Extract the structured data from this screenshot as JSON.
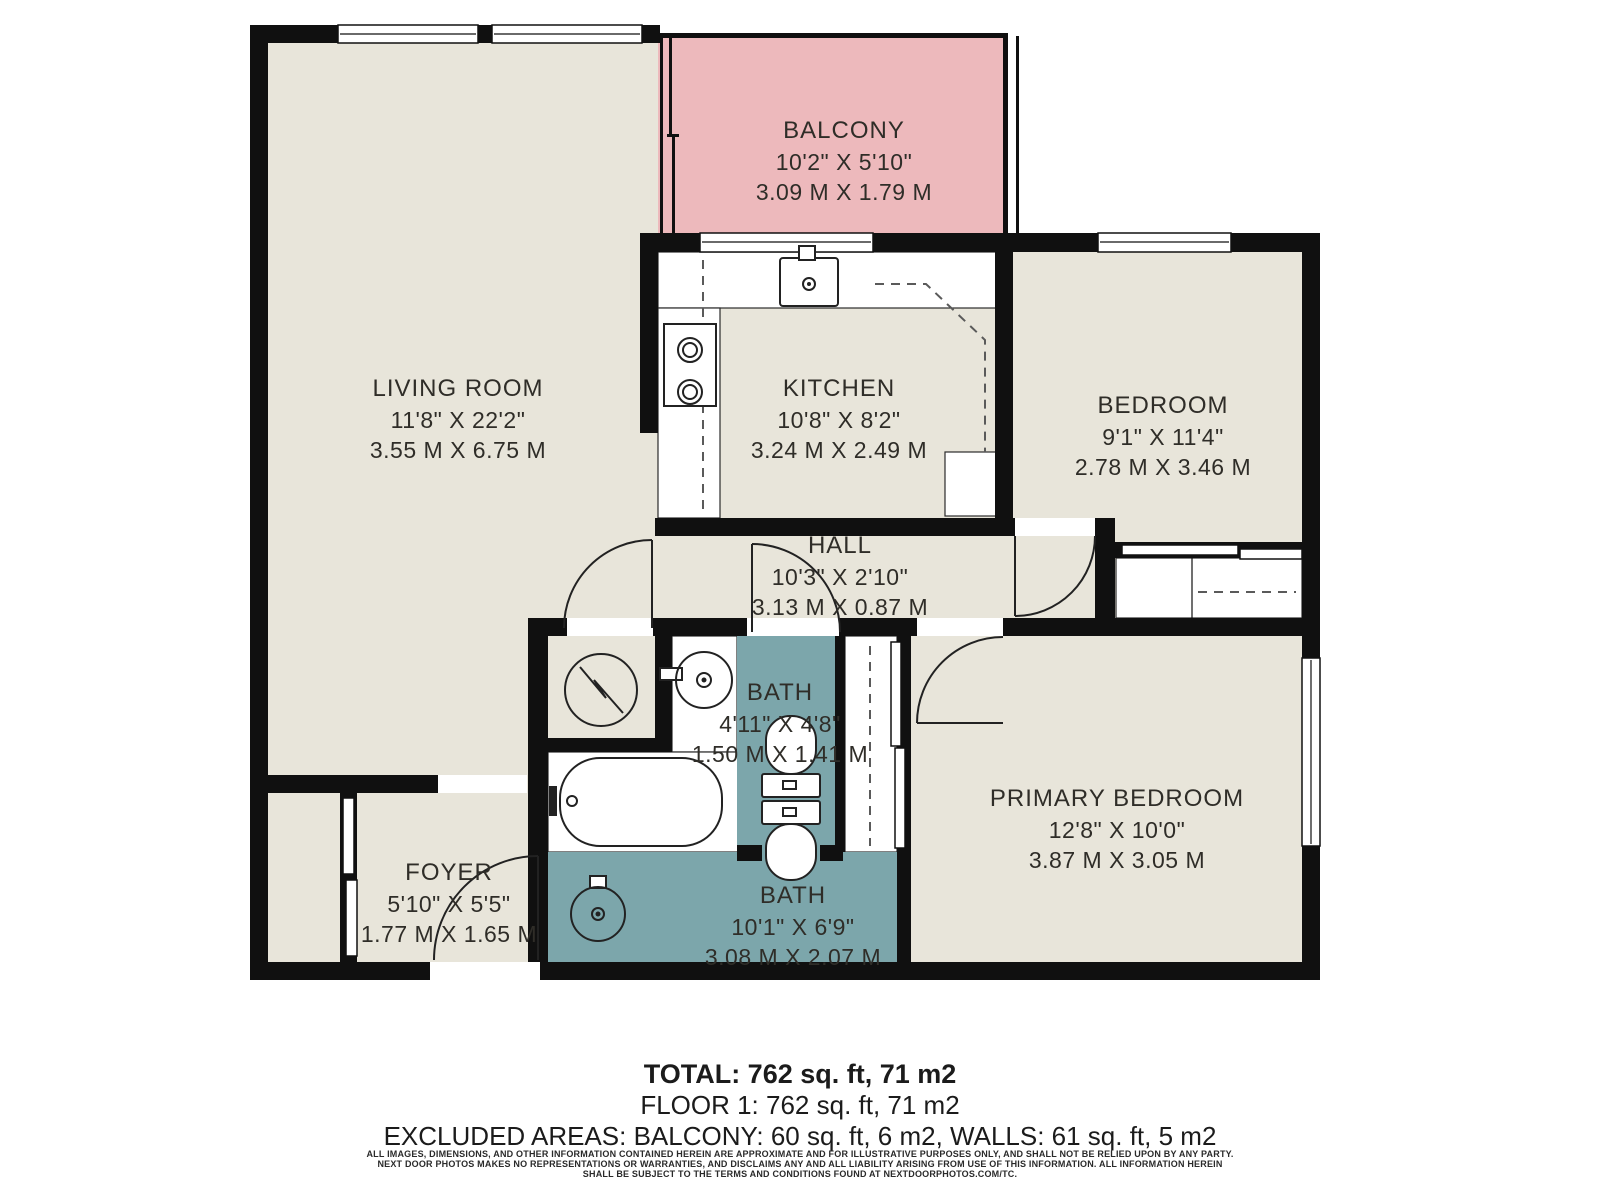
{
  "rooms": {
    "balcony": {
      "name": "BALCONY",
      "imperial": "10'2\" X 5'10\"",
      "metric": "3.09 M X 1.79 M"
    },
    "living_room": {
      "name": "LIVING ROOM",
      "imperial": "11'8\" X 22'2\"",
      "metric": "3.55 M X 6.75 M"
    },
    "kitchen": {
      "name": "KITCHEN",
      "imperial": "10'8\" X 8'2\"",
      "metric": "3.24 M X 2.49 M"
    },
    "bedroom": {
      "name": "BEDROOM",
      "imperial": "9'1\" X 11'4\"",
      "metric": "2.78 M X 3.46 M"
    },
    "hall": {
      "name": "HALL",
      "imperial": "10'3\" X 2'10\"",
      "metric": "3.13 M X 0.87 M"
    },
    "bath_upper": {
      "name": "BATH",
      "imperial": "4'11\" X 4'8\"",
      "metric": "1.50 M X 1.41 M"
    },
    "primary_bedroom": {
      "name": "PRIMARY BEDROOM",
      "imperial": "12'8\" X 10'0\"",
      "metric": "3.87 M X 3.05 M"
    },
    "foyer": {
      "name": "FOYER",
      "imperial": "5'10\" X 5'5\"",
      "metric": "1.77 M X 1.65 M"
    },
    "bath_lower": {
      "name": "BATH",
      "imperial": "10'1\" X 6'9\"",
      "metric": "3.08 M X 2.07 M"
    }
  },
  "summary": {
    "total": "TOTAL: 762 sq. ft, 71 m2",
    "floor": "FLOOR 1: 762 sq. ft, 71 m2",
    "excluded": "EXCLUDED AREAS: BALCONY: 60 sq. ft, 6 m2, WALLS: 61 sq. ft, 5 m2"
  },
  "disclaimer": {
    "line1": "ALL IMAGES, DIMENSIONS, AND OTHER INFORMATION CONTAINED HEREIN ARE APPROXIMATE AND FOR ILLUSTRATIVE PURPOSES ONLY, AND SHALL NOT BE RELIED UPON BY ANY PARTY.",
    "line2": "NEXT DOOR PHOTOS MAKES NO REPRESENTATIONS OR WARRANTIES, AND DISCLAIMS ANY AND ALL LIABILITY ARISING FROM USE OF THIS INFORMATION. ALL INFORMATION HEREIN",
    "line3": "SHALL BE SUBJECT TO THE TERMS AND CONDITIONS FOUND AT NEXTDOORPHOTOS.COM/TC."
  },
  "colors": {
    "room_floor": "#e8e5da",
    "balcony": "#edb9bc",
    "bath": "#7ca6ab",
    "walls": "#101010",
    "label_text": "#2f2d28"
  }
}
